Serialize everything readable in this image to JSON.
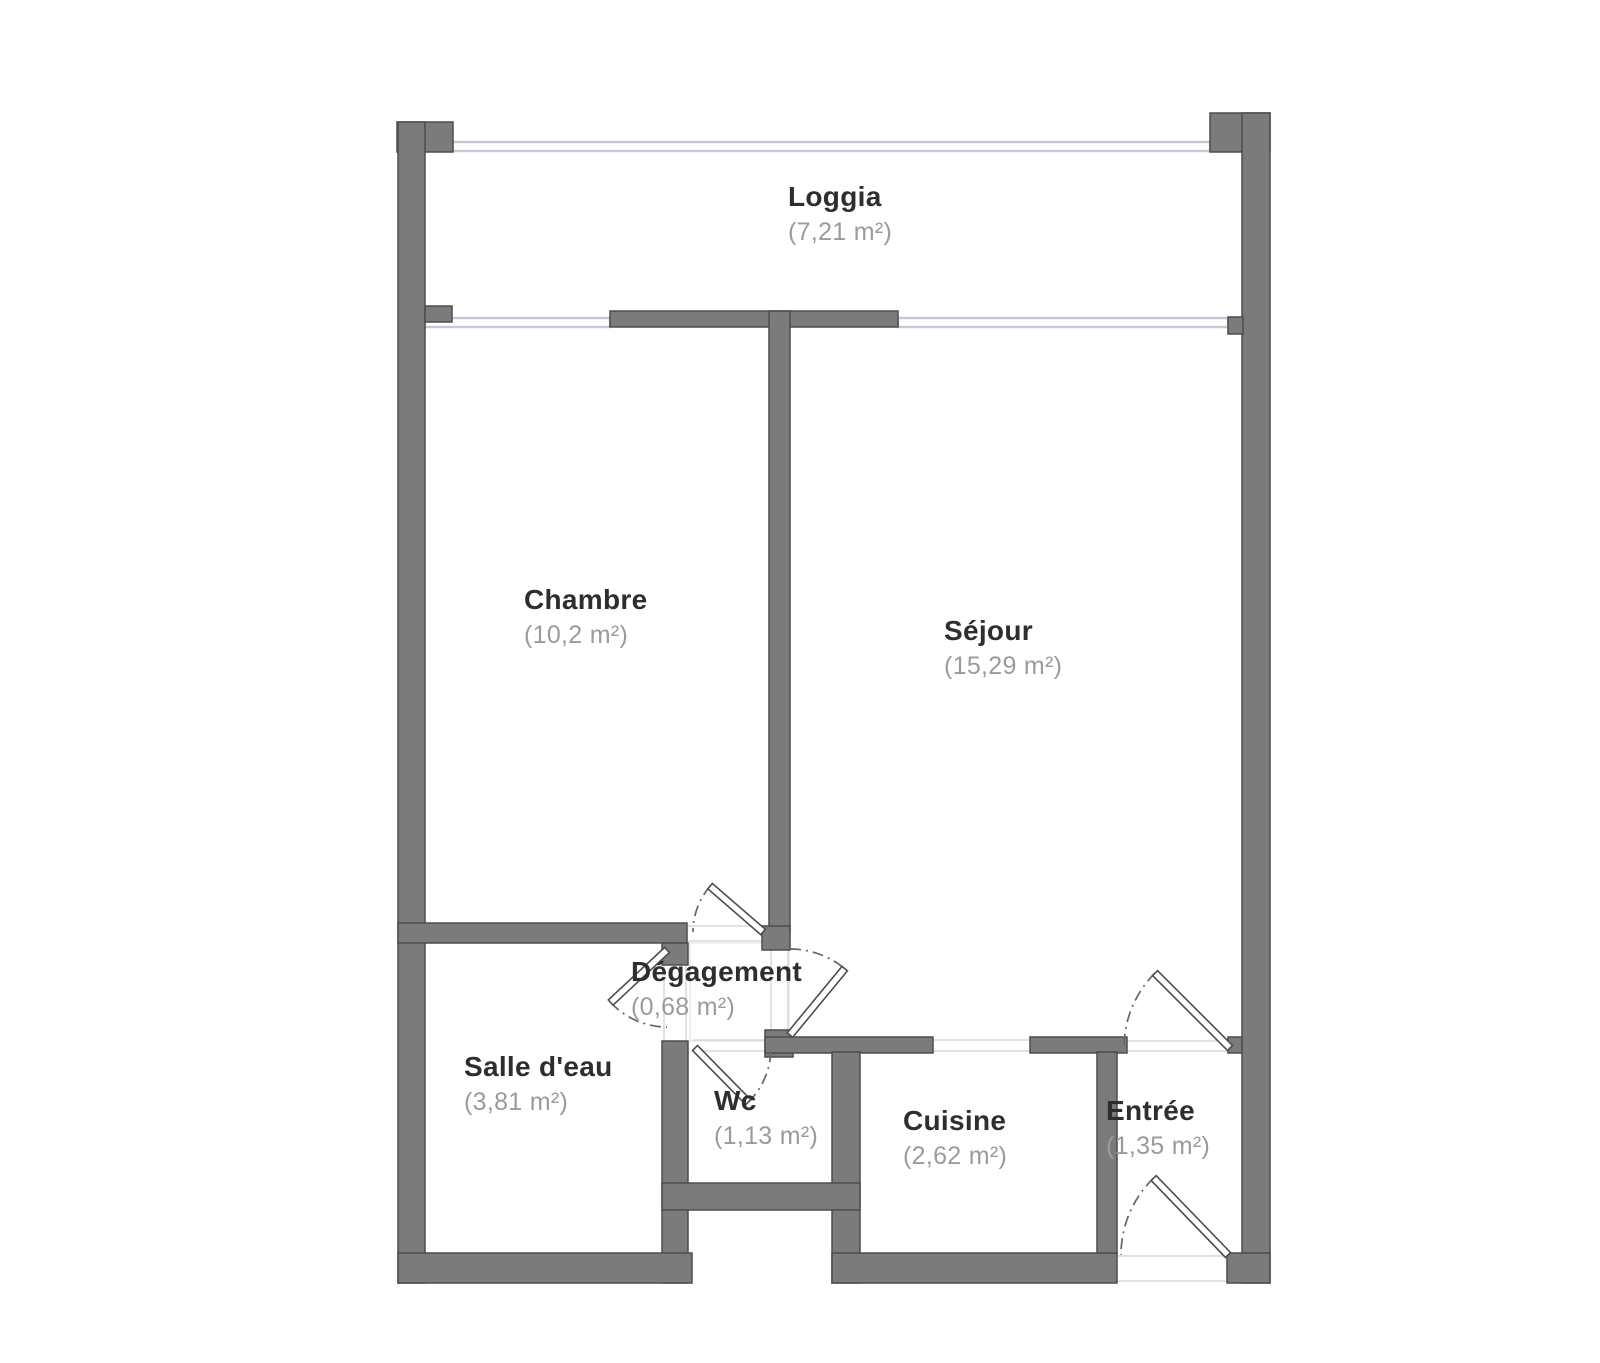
{
  "plan": {
    "type": "apartment-floor-plan",
    "colors": {
      "wall_fill": "#7b7b7b",
      "wall_stroke": "#4d4d4d",
      "window_line": "#c6c6d8",
      "door_stroke": "#4d4d4d",
      "door_arc": "#666666",
      "threshold_line": "#d9d9d9",
      "hall_outline": "#e4e4e4",
      "room_name_text": "#2e2e2e",
      "room_area_text": "#9b9b9b",
      "background": "#ffffff"
    },
    "symbols": {
      "door": "door-swing-icon",
      "window": "double-line-window"
    }
  },
  "rooms": [
    {
      "id": "loggia",
      "name": "Loggia",
      "area": "(7,21 m²)"
    },
    {
      "id": "chambre",
      "name": "Chambre",
      "area": "(10,2 m²)"
    },
    {
      "id": "sejour",
      "name": "Séjour",
      "area": "(15,29 m²)"
    },
    {
      "id": "degagement",
      "name": "Dégagement",
      "area": "(0,68 m²)"
    },
    {
      "id": "salle_deau",
      "name": "Salle d'eau",
      "area": "(3,81 m²)"
    },
    {
      "id": "wc",
      "name": "Wc",
      "area": "(1,13 m²)"
    },
    {
      "id": "cuisine",
      "name": "Cuisine",
      "area": "(2,62 m²)"
    },
    {
      "id": "entree",
      "name": "Entrée",
      "area": "(1,35 m²)"
    }
  ]
}
